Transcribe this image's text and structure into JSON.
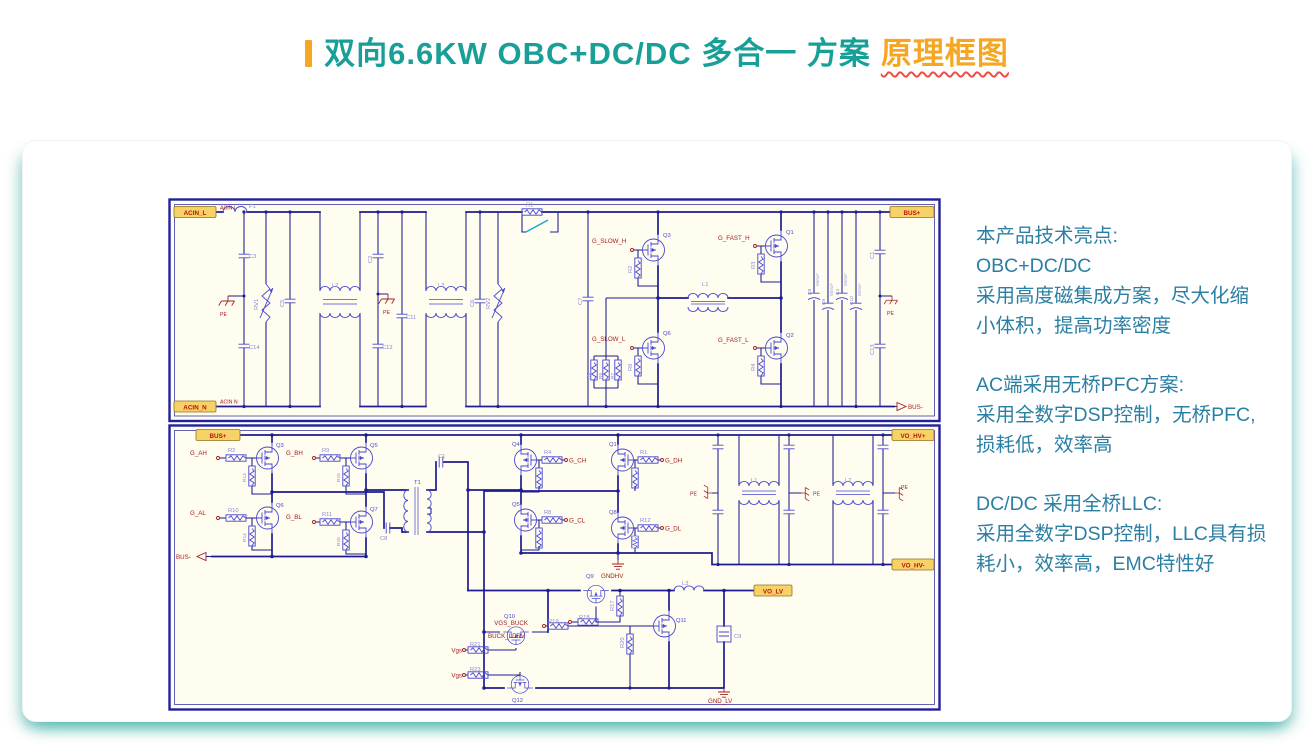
{
  "title": {
    "teal": "双向6.6KW OBC+DC/DC 多合一 方案",
    "orange": "原理框图"
  },
  "notes": {
    "blocks": [
      {
        "lines": [
          "本产品技术亮点:",
          "OBC+DC/DC",
          "采用高度磁集成方案，尽大化缩",
          "小体积，提高功率密度"
        ]
      },
      {
        "lines": [
          "AC端采用无桥PFC方案:",
          "采用全数字DSP控制，无桥PFC,",
          "损耗低，效率高"
        ]
      },
      {
        "lines": [
          "DC/DC 采用全桥LLC:",
          "采用全数字DSP控制，LLC具有损",
          "耗小，效率高，EMC特性好"
        ]
      }
    ]
  },
  "sch": {
    "up": {
      "ports": {
        "acin_l": "ACIN_L",
        "acin_n": "ACIN_N",
        "bus_p": "BUS+",
        "bus_n": "BUS-"
      },
      "nets": {
        "acin_l": "ACIN L",
        "acin_n": "ACIN N"
      },
      "sig": {
        "slow_h": "G_SLOW_H",
        "slow_l": "G_SLOW_L",
        "fast_h": "G_FAST_H",
        "fast_l": "G_FAST_L"
      },
      "pe": "PE",
      "refs": {
        "f1": "F1",
        "c3": "C3",
        "c14": "C14",
        "rv1": "RV1",
        "c5": "C5",
        "l2": "L2",
        "c2": "C2",
        "c12": "C12",
        "c11": "C11",
        "l3": "L3",
        "c6": "C6",
        "rv2": "RV2",
        "r1": "R1",
        "c7": "C7",
        "q3": "Q3",
        "r2": "R2",
        "q6": "Q6",
        "r8": "R8",
        "r5": "R5",
        "r6": "R6",
        "r7": "R7",
        "l1": "L1",
        "q1": "Q1",
        "r3": "R3",
        "q2": "Q2",
        "r4": "R4",
        "c8": "C8",
        "c9": "C9",
        "c4": "C4",
        "c10": "C10",
        "c1": "C1",
        "c13": "C13"
      },
      "val": {
        "bulk": "560uF"
      }
    },
    "lo": {
      "ports": {
        "bus_p": "BUS+",
        "bus_n": "BUS-",
        "vo_hv_p": "VO_HV+",
        "vo_hv_n": "VO_HV-",
        "vo_lv": "VO_LV"
      },
      "gnd": {
        "gndhv": "GNDHV",
        "gnd_lv": "GND_LV",
        "pe": "PE"
      },
      "sig": {
        "g_ah": "G_AH",
        "g_bh": "G_BH",
        "g_al": "G_AL",
        "g_bl": "G_BL",
        "g_ch": "G_CH",
        "g_dh": "G_DH",
        "g_cl": "G_CL",
        "g_dl": "G_DL",
        "vgs_buck": "VGS_BUCK",
        "buck_ldrv": "BUCK_LDRV",
        "vgs": "Vgs"
      },
      "refs": {
        "q3": "Q3",
        "q5": "Q5",
        "q6": "Q6",
        "q7": "Q7",
        "r2": "R2",
        "r9": "R9",
        "r10": "R10",
        "r11": "R11",
        "r13": "R13",
        "r14": "R14",
        "r15": "R15",
        "r16": "R16",
        "t1": "T1",
        "c8": "C8",
        "c1": "C1",
        "q4": "Q4",
        "q1": "Q1",
        "q5s": "Q5",
        "q8": "Q8",
        "r4": "R4",
        "r1": "R1",
        "r8": "R8",
        "r12": "R12",
        "l1": "L1",
        "l2": "L2",
        "l3": "L3",
        "q9": "Q9",
        "q10": "Q10",
        "q11": "Q11",
        "q12": "Q12",
        "r17": "R17",
        "r18": "R18",
        "r19": "R19",
        "r20": "R20",
        "r21": "R21",
        "r23": "R23",
        "c9": "C9"
      }
    }
  },
  "colors": {
    "teal": "#18A098",
    "orange": "#F5A623",
    "underline": "#F04E45",
    "note_text": "#2B7FA3",
    "sheet_bg": "#FFFCF0",
    "sheet_border": "#21219B",
    "wire": "#1D1D8F",
    "component": "#4747D1",
    "ref_text": "#8A8AD2",
    "faint_text": "#A9A9DA",
    "sch_red": "#A42020",
    "port_fill": "#F7D266",
    "port_border": "#93731F",
    "port_text": "#BB1111",
    "relay_cyan": "#18A8CC",
    "card_shadow": "#4DB6AC"
  }
}
